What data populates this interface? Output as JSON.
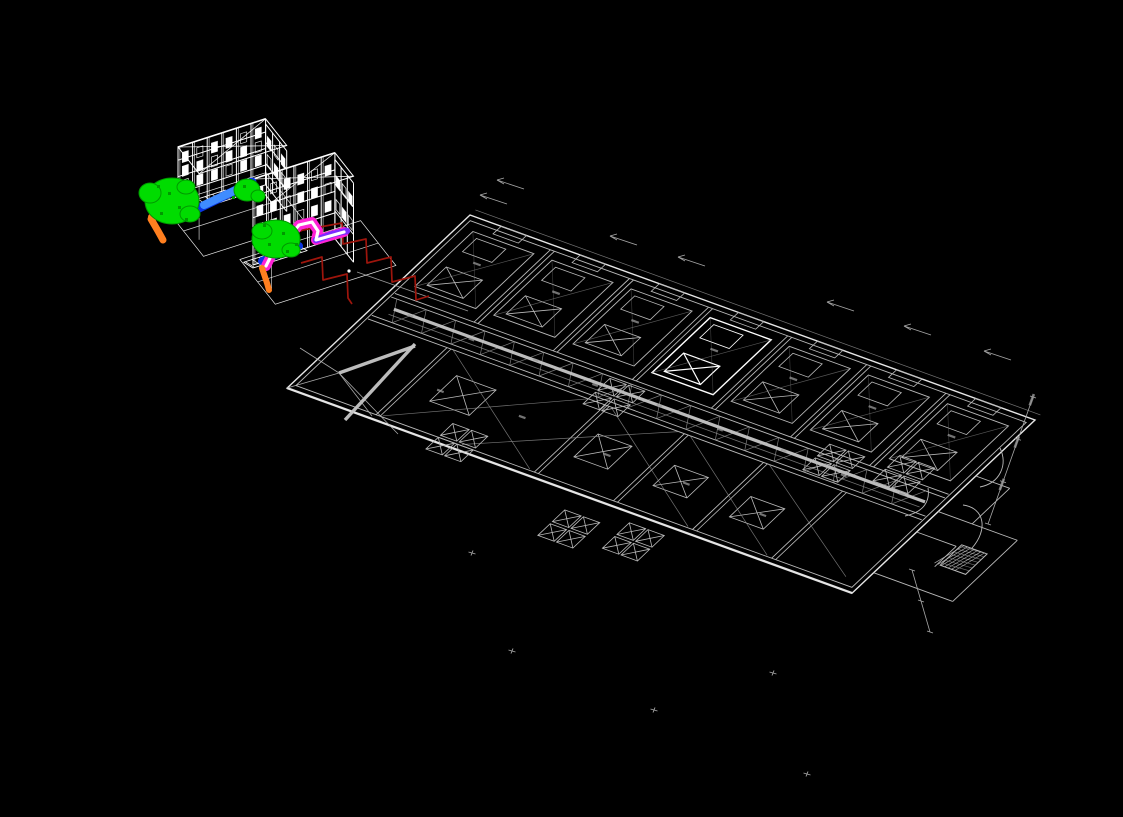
{
  "viewport": {
    "width": 1123,
    "height": 817,
    "background": "#000000"
  },
  "palette": {
    "wireframe": "#ffffff",
    "plan": "#b9b9b9",
    "plan_dim": "#8f8f8f",
    "plan_bright": "#e6e6e6",
    "highlight": "#ffffff",
    "duct_thick": "#c6c6c6",
    "equipment_green": "#00dc00",
    "equipment_green_dark": "#009900",
    "duct_blue": "#0a35e0",
    "duct_blue_light": "#3f8cff",
    "fitting_orange": "#ff7f1f",
    "pipe_magenta": "#ff22d6",
    "pipe_purple": "#7c2bff",
    "pipe_white": "#ffffff",
    "pipe_red": "#9e150c",
    "annotation": "#a8a8a8",
    "smudge": "#9a9a9a"
  },
  "wireframe_units": [
    {
      "name": "rooftop-unit-frame-1",
      "anchor": [
        178,
        213
      ],
      "length": 92,
      "height": 66,
      "depth": 34,
      "posts": 6,
      "side_posts": 3,
      "platform_scale": 1.15
    },
    {
      "name": "rooftop-unit-frame-2",
      "anchor": [
        253,
        265
      ],
      "length": 86,
      "height": 86,
      "depth": 30,
      "posts": 6,
      "side_posts": 3,
      "platform_scale": 1.45
    }
  ],
  "piping_unit_1": {
    "green_blobs": [
      [
        172,
        201,
        27,
        23
      ],
      [
        150,
        193,
        11,
        10
      ],
      [
        190,
        214,
        10,
        8
      ],
      [
        186,
        187,
        9,
        7
      ],
      [
        247,
        190,
        13,
        11
      ],
      [
        258,
        196,
        7,
        6
      ]
    ],
    "green_specks": [
      [
        160,
        212
      ],
      [
        178,
        206
      ],
      [
        168,
        192
      ],
      [
        185,
        218
      ],
      [
        243,
        185
      ],
      [
        232,
        196
      ],
      [
        157,
        185
      ]
    ],
    "blue_main": [
      [
        167,
        219
      ],
      [
        193,
        211
      ],
      [
        228,
        194
      ],
      [
        252,
        182
      ]
    ],
    "blue_light": [
      [
        204,
        205
      ],
      [
        236,
        190
      ]
    ],
    "orange_path": [
      [
        151,
        219
      ],
      [
        158,
        231
      ],
      [
        163,
        240
      ]
    ],
    "orange_blob": [
      153,
      217,
      5,
      4
    ]
  },
  "piping_unit_2": {
    "green_blobs": [
      [
        276,
        239,
        24,
        19
      ],
      [
        262,
        231,
        10,
        8
      ],
      [
        291,
        250,
        9,
        7
      ]
    ],
    "green_specks": [
      [
        268,
        243
      ],
      [
        282,
        232
      ],
      [
        286,
        250
      ],
      [
        263,
        224
      ],
      [
        295,
        243
      ]
    ],
    "blue_main": [
      [
        262,
        261
      ],
      [
        283,
        252
      ],
      [
        299,
        246
      ]
    ],
    "magenta_path": [
      [
        266,
        266
      ],
      [
        273,
        252
      ],
      [
        286,
        241
      ],
      [
        299,
        225
      ],
      [
        312,
        222
      ],
      [
        318,
        231
      ],
      [
        316,
        240
      ],
      [
        330,
        236
      ],
      [
        344,
        232
      ]
    ],
    "purple_segment": [
      [
        316,
        240
      ],
      [
        333,
        234
      ],
      [
        347,
        231
      ]
    ],
    "orange_path": [
      [
        262,
        268
      ],
      [
        267,
        283
      ],
      [
        269,
        290
      ]
    ]
  },
  "red_pipes": [
    [
      [
        267,
        257
      ],
      [
        281,
        239
      ],
      [
        303,
        230
      ],
      [
        342,
        223
      ],
      [
        343,
        244
      ],
      [
        366,
        239
      ],
      [
        367,
        263
      ],
      [
        391,
        257
      ],
      [
        392,
        282
      ],
      [
        415,
        276
      ],
      [
        416,
        300
      ],
      [
        429,
        296
      ]
    ],
    [
      [
        301,
        263
      ],
      [
        322,
        257
      ],
      [
        323,
        280
      ],
      [
        347,
        274
      ],
      [
        348,
        298
      ],
      [
        352,
        304
      ]
    ]
  ],
  "leader_line": [
    357,
    272,
    468,
    311
  ],
  "point_dot": [
    349,
    271
  ],
  "floor_plan": {
    "origin": [
      470,
      215
    ],
    "u": [
      5.65,
      2.05
    ],
    "v": [
      -5.38,
      5.09
    ],
    "length": 100,
    "width": 34,
    "bay_width": 14,
    "bays": 7,
    "highlight_bay": 3,
    "corridor": [
      15,
      20
    ],
    "south_partitions": [
      15,
      43,
      57,
      71,
      85
    ],
    "south_xboxes": [
      [
        20,
        23.5,
        7,
        5
      ],
      [
        46,
        24.5,
        6,
        4.5
      ],
      [
        60,
        25,
        6,
        4
      ],
      [
        74,
        25.5,
        6,
        4
      ]
    ],
    "south_diagonals": [
      [
        16,
        20,
        42,
        33
      ],
      [
        44,
        20,
        70,
        33
      ],
      [
        58,
        20,
        84,
        33
      ],
      [
        30,
        33,
        56,
        20
      ],
      [
        72,
        20,
        97,
        32
      ],
      [
        16,
        33,
        40,
        20
      ]
    ],
    "grille_clusters": [
      [
        26,
        30.5
      ],
      [
        52,
        37
      ],
      [
        62,
        35.5
      ],
      [
        77,
        14
      ],
      [
        87.5,
        12
      ],
      [
        40,
        16
      ]
    ],
    "corridor_smudges": [
      [
        6,
        17.4
      ],
      [
        17,
        17.6
      ],
      [
        28,
        17.2
      ],
      [
        39,
        17.7
      ],
      [
        50,
        17.3
      ],
      [
        61,
        17.6
      ],
      [
        72,
        17.3
      ],
      [
        83,
        17.7
      ],
      [
        93,
        17.4
      ]
    ],
    "south_smudges": [
      [
        20,
        26.5
      ],
      [
        34,
        26
      ],
      [
        50,
        27
      ],
      [
        64,
        27
      ],
      [
        78,
        27.5
      ]
    ],
    "thick_lines": [
      [
        415,
        344,
        345,
        420
      ],
      [
        339,
        373,
        415,
        346
      ]
    ],
    "fan_center": [
      339,
      373
    ],
    "fan_targets": [
      [
        300,
        348
      ],
      [
        372,
        416
      ],
      [
        398,
        434
      ],
      [
        287,
        388
      ]
    ],
    "annex_lines": [
      [
        [
          100,
          11
        ],
        [
          106,
          11
        ]
      ],
      [
        [
          106,
          11
        ],
        [
          106,
          18
        ]
      ],
      [
        [
          100,
          18
        ],
        [
          114,
          18
        ]
      ],
      [
        [
          114,
          18
        ],
        [
          114,
          30
        ]
      ],
      [
        [
          100,
          30
        ],
        [
          114,
          30
        ]
      ],
      [
        [
          100,
          22
        ],
        [
          107,
          22
        ]
      ],
      [
        [
          107,
          22
        ],
        [
          107,
          26
        ]
      ]
    ],
    "hatch_box": [
      107.5,
      21.5,
      4.5,
      4
    ],
    "door_arcs": [
      "M 963,505 C 985,508 988,530 972,548",
      "M 980,487 C 1000,483 1008,465 1000,448",
      "M 905,516 C 925,512 930,500 928,488"
    ],
    "dim_line_right": [
      1033,
      397,
      988,
      524
    ],
    "dim_line_se": [
      912,
      570,
      930,
      632
    ]
  },
  "annotations": {
    "arrows": [
      [
        497,
        180
      ],
      [
        480,
        195
      ],
      [
        610,
        236
      ],
      [
        678,
        257
      ],
      [
        827,
        302
      ],
      [
        904,
        326
      ],
      [
        984,
        351
      ]
    ],
    "crosses": [
      [
        512,
        651
      ],
      [
        773,
        673
      ],
      [
        654,
        710
      ],
      [
        807,
        774
      ],
      [
        472,
        553
      ]
    ]
  }
}
